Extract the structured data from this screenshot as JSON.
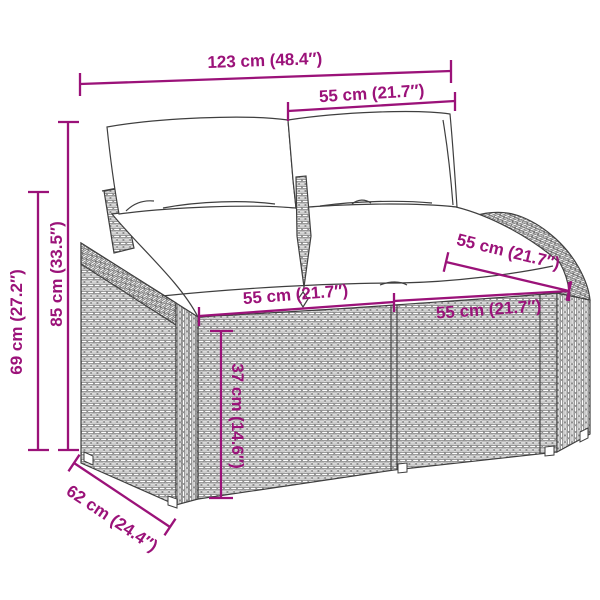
{
  "diagram": {
    "title": "garden-sofa-dimension-diagram",
    "product": "poly rattan 2-seater garden sofa with cushions",
    "background_color": "#ffffff",
    "accent_color": "#9B1279",
    "line_color": "#3f3f3f",
    "measurements": {
      "overall_width": {
        "label": "123 cm (48.4″)",
        "value_cm": 123,
        "value_in": 48.4
      },
      "back_cushion_width": {
        "label": "55 cm (21.7″)",
        "value_cm": 55,
        "value_in": 21.7
      },
      "total_height": {
        "label": "85 cm (33.5″)",
        "value_cm": 85,
        "value_in": 33.5
      },
      "armrest_height": {
        "label": "69 cm (27.2″)",
        "value_cm": 69,
        "value_in": 27.2
      },
      "left_seat_width": {
        "label": "55 cm (21.7″)",
        "value_cm": 55,
        "value_in": 21.7
      },
      "armrest_depth": {
        "label": "55 cm (21.7″)",
        "value_cm": 55,
        "value_in": 21.7
      },
      "right_seat_width": {
        "label": "55 cm (21.7″)",
        "value_cm": 55,
        "value_in": 21.7
      },
      "seat_height": {
        "label": "37 cm (14.6″)",
        "value_cm": 37,
        "value_in": 14.6
      },
      "seat_depth": {
        "label": "62 cm (24.4″)",
        "value_cm": 62,
        "value_in": 24.4
      }
    }
  }
}
